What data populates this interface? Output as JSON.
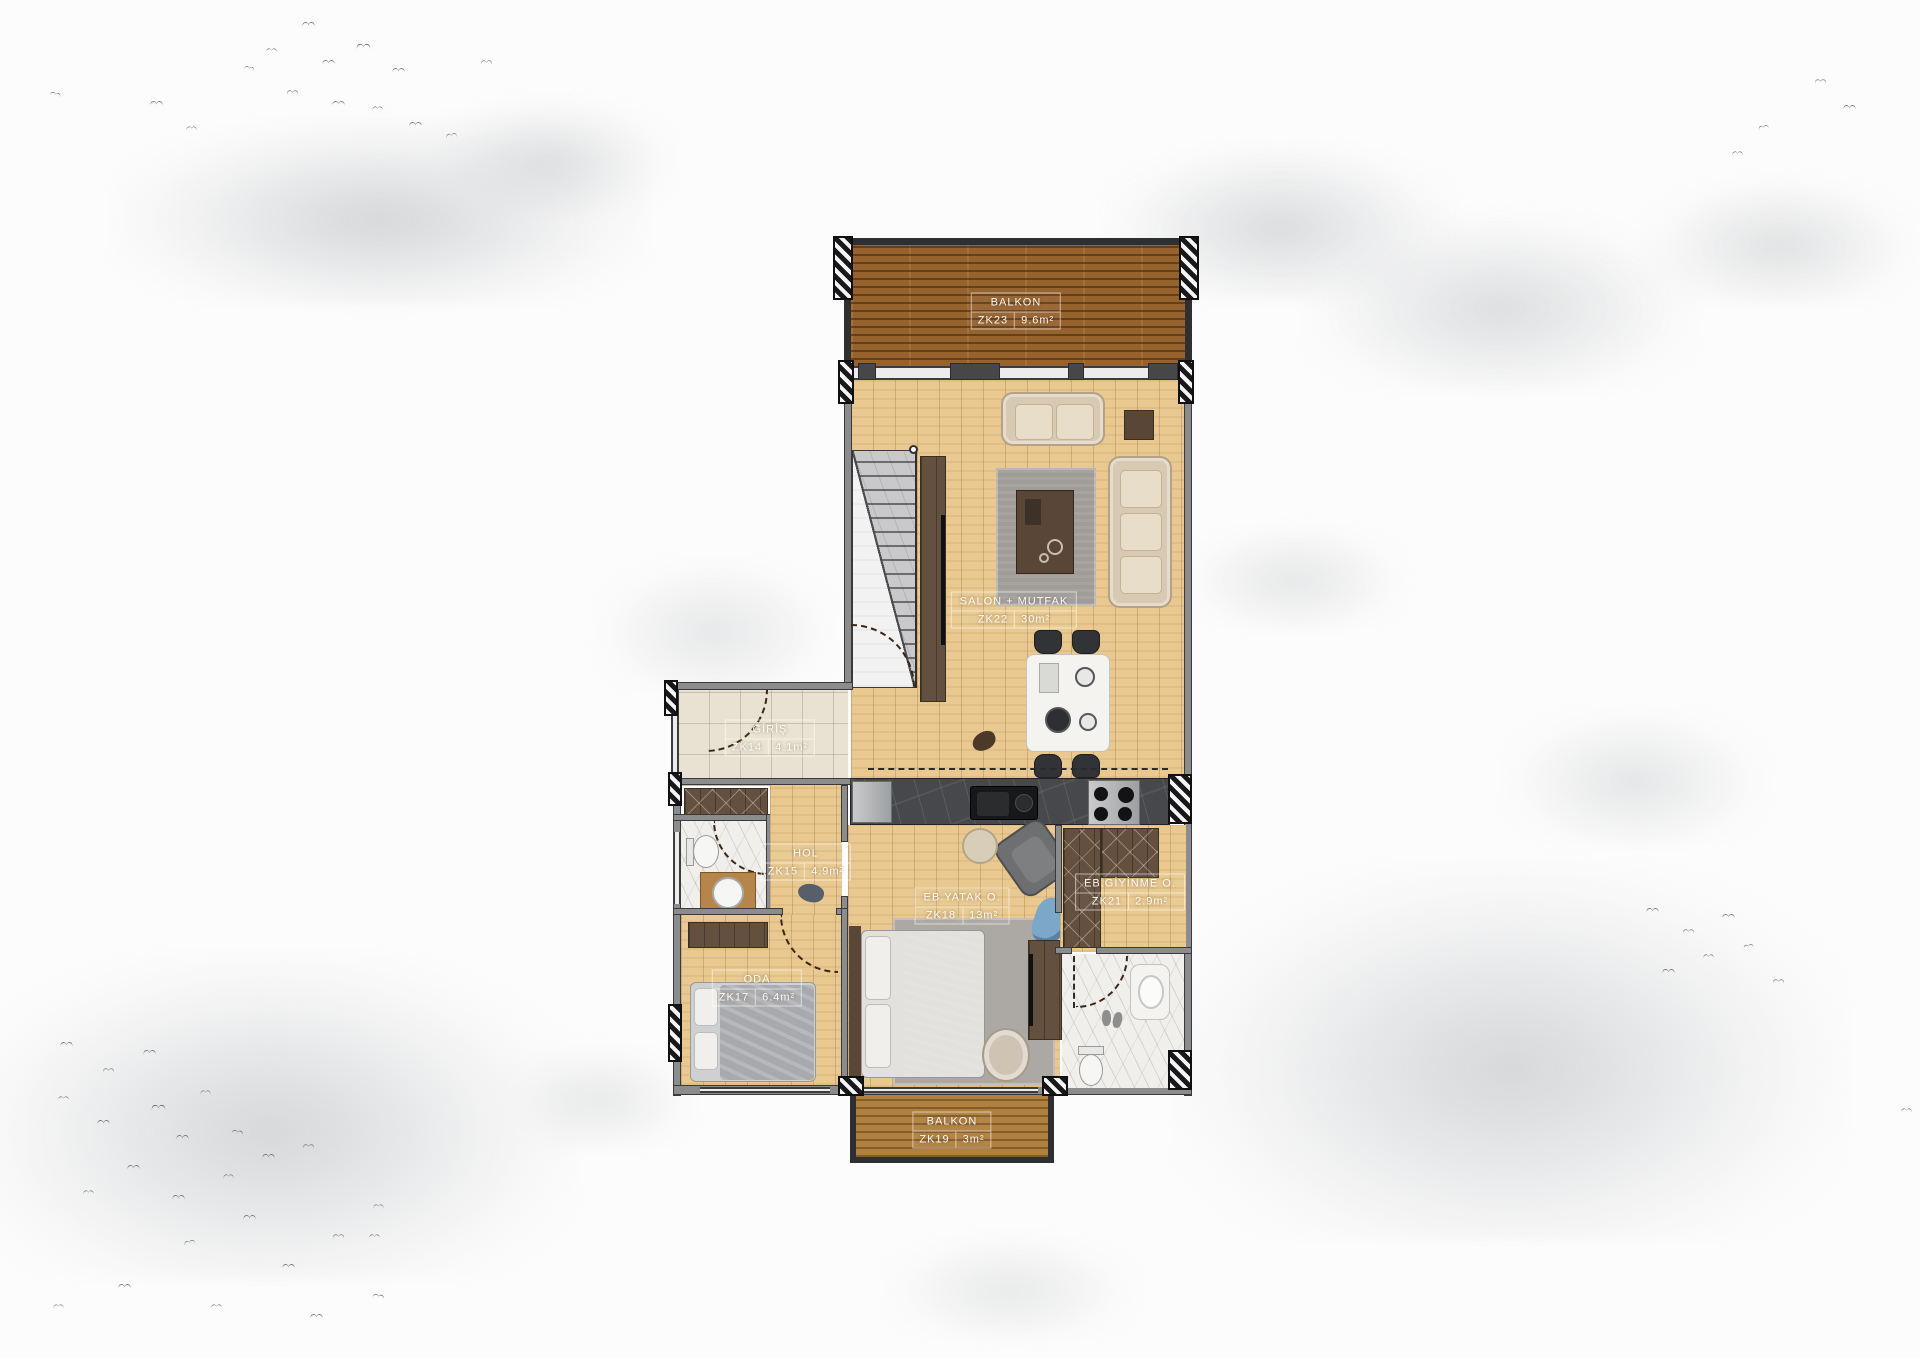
{
  "plan": {
    "type": "apartment-floor-plan",
    "rooms": [
      {
        "name": "BALKON",
        "code": "ZK23",
        "area": "9.6m²"
      },
      {
        "name": "SALON + MUTFAK",
        "code": "ZK22",
        "area": "30m²"
      },
      {
        "name": "GİRİŞ",
        "code": "ZK14",
        "area": "4.1m²"
      },
      {
        "name": "HOL",
        "code": "ZK15",
        "area": "4.9m²"
      },
      {
        "name": "EB.YATAK O.",
        "code": "ZK18",
        "area": "13m²"
      },
      {
        "name": "EB.GİYİNME O.",
        "code": "ZK21",
        "area": "2.9m²"
      },
      {
        "name": "ODA",
        "code": "ZK17",
        "area": "6.4m²"
      },
      {
        "name": "BALKON",
        "code": "ZK19",
        "area": "3m²"
      }
    ],
    "colors": {
      "balcony_wood": "#96632f",
      "interior_wood": "#e9c990",
      "entry_tile": "#e9e2d2",
      "bath_marble": "#f1efeb",
      "kitchen_counter": "#47484c",
      "wall_gray": "#8b8c8e",
      "wardrobe_wood": "#63503f",
      "label_text": "#ffffff"
    }
  }
}
